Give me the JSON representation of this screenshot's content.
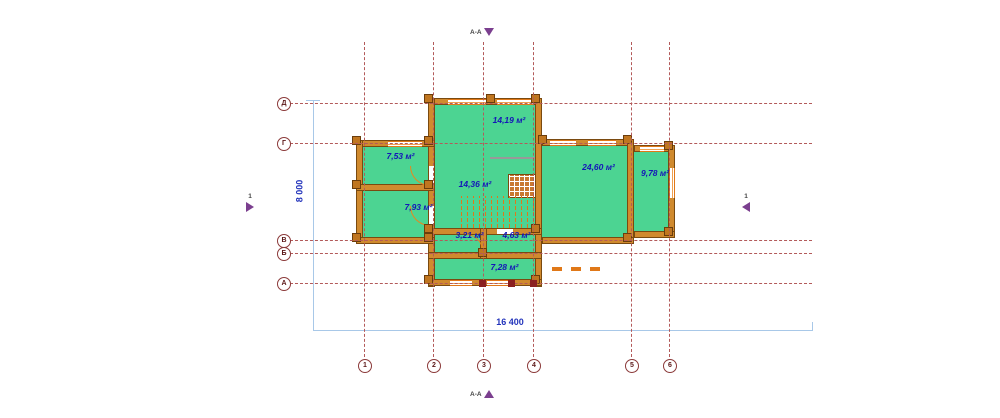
{
  "drawing": {
    "type": "floor-plan",
    "rooms": [
      {
        "name": "room-top",
        "area": "14,19 м²"
      },
      {
        "name": "room-upper-left",
        "area": "7,53 м²"
      },
      {
        "name": "room-lower-left",
        "area": "7,93 м²"
      },
      {
        "name": "room-center-hall",
        "area": "14,36 м²"
      },
      {
        "name": "room-right-large",
        "area": "24,60 м²"
      },
      {
        "name": "room-right-small",
        "area": "9,78 м²"
      },
      {
        "name": "room-small-1",
        "area": "3,21 м²"
      },
      {
        "name": "room-small-2",
        "area": "4,63 м²"
      },
      {
        "name": "room-bottom",
        "area": "7,28 м²"
      }
    ],
    "grid": {
      "row_labels": [
        "Д",
        "Г",
        "В",
        "Б",
        "А"
      ],
      "col_labels": [
        "1",
        "2",
        "3",
        "4",
        "5",
        "6"
      ]
    },
    "dimensions": {
      "overall_width": "16 400",
      "overall_height": "8 000"
    },
    "sections": {
      "vertical_label": "А-А",
      "horizontal_label": "1"
    },
    "colors": {
      "room_fill": "#4cd492",
      "wall_fill": "#d08a2e",
      "grid_line": "#b35a5a",
      "dimension_line": "#a8c8e8",
      "area_text": "#1515b8",
      "section_arrow": "#7b3f8f"
    }
  }
}
